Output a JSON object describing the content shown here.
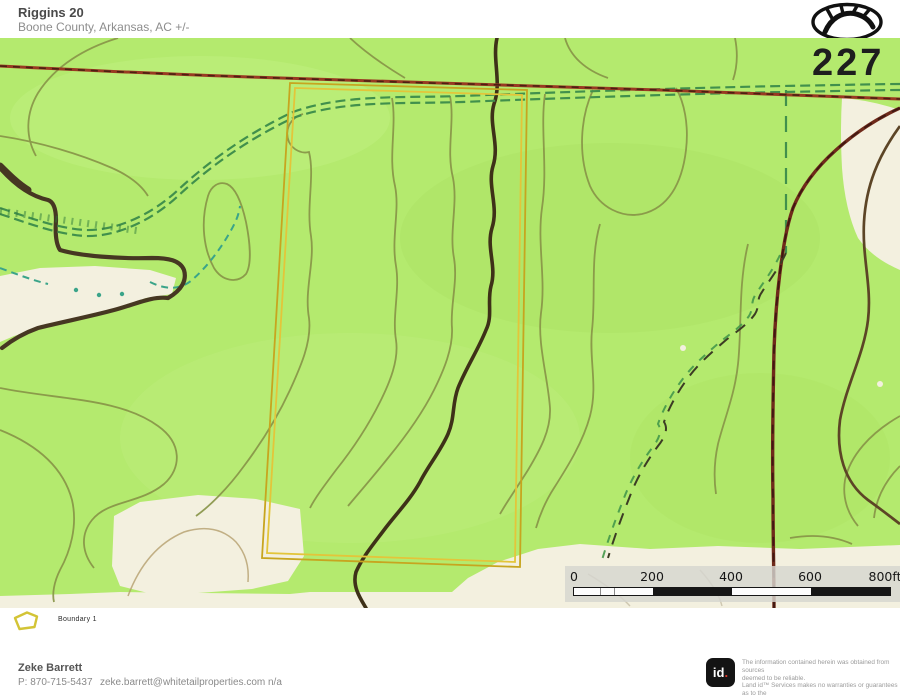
{
  "header": {
    "title": "Riggins 20",
    "subtitle": "Boone County, Arkansas,  AC +/-"
  },
  "map": {
    "road_label": "227",
    "scalebar": {
      "labels": [
        "0",
        "200",
        "400",
        "600",
        "800ft"
      ]
    }
  },
  "legend": {
    "items": [
      {
        "label": "Boundary 1",
        "color": "#d8b62a"
      }
    ]
  },
  "footer": {
    "agent_name": "Zeke Barrett",
    "agent_phone": "P: 870-715-5437",
    "agent_email": "zeke.barrett@whitetailproperties.com",
    "agent_extra": "n/a",
    "logo_id": "id",
    "logo_dot": ".",
    "disclaimer_lines": [
      "The information contained herein was obtained from sources",
      "deemed to be reliable.",
      "Land id™ Services makes no warranties or guarantees as to the",
      "completeness or accuracy thereof."
    ]
  },
  "colors": {
    "map_green": "#b4ea6e",
    "clearing_cream": "#f3f0df",
    "boundary_yellow": "#d8b62a",
    "road_red": "#993a22",
    "road_maroon": "#6f2a1a",
    "trail_green": "#41904c",
    "stream_teal": "#3aa489",
    "contour_olive": "#879347",
    "contour_dark": "#5c4526",
    "id_dot_red": "#e23b2e"
  }
}
